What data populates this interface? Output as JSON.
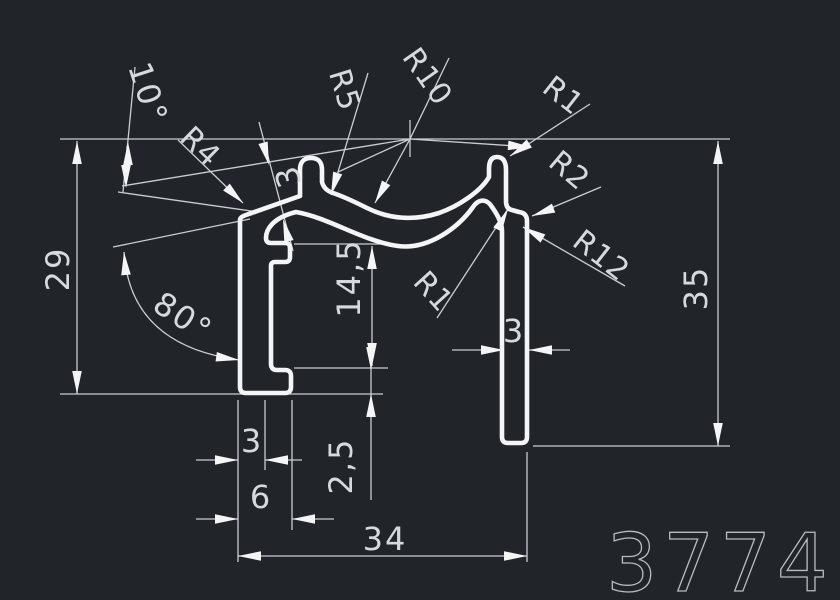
{
  "drawing": {
    "title": "profile cross-section drawing",
    "profile_number": "3774",
    "colors": {
      "background": "#21252a",
      "profile_line": "#f3f5f7",
      "dimension_line": "#c9ced3",
      "text": "#d6dade",
      "number_text": "#b6bcc2"
    }
  },
  "labels": {
    "angle_10": "10°",
    "angle_80": "80°",
    "r4": "R4",
    "r5": "R5",
    "r10": "R10",
    "r1_top": "R1",
    "r2": "R2",
    "r12": "R12",
    "r1_mid": "R1",
    "dim_29": "29",
    "dim_35": "35",
    "dim_14_5": "14,5",
    "dim_2_5": "2,5",
    "dim_3_top": "3",
    "dim_3_right": "3",
    "dim_3_bottom": "3",
    "dim_6": "6",
    "dim_34": "34",
    "profile_number": "3774"
  }
}
